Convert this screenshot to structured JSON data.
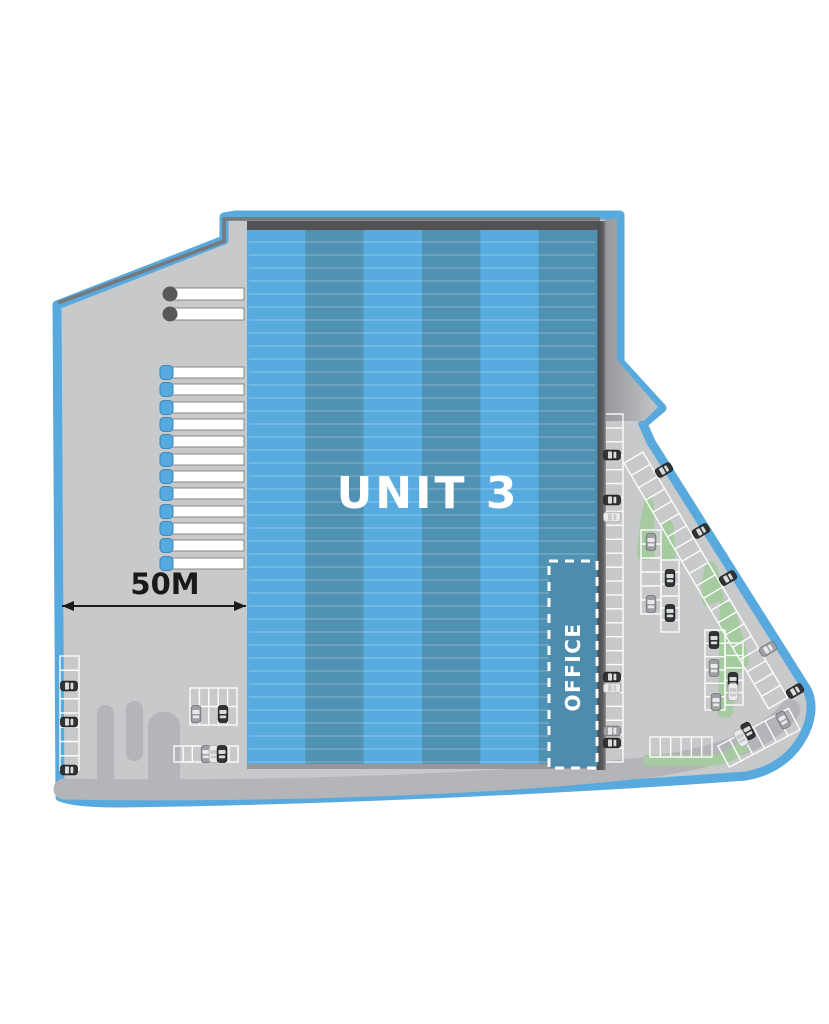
{
  "title": "Warehouse site plan - Unit 3",
  "labels": {
    "unit": "UNIT 3",
    "office": "OFFICE",
    "dimension": "50M"
  },
  "colors": {
    "boundary": "#57A9DE",
    "pavement": "#C7C9CB",
    "road": "#B3B5B8",
    "road_dark": "#B7B9BB",
    "edge_dark": "#76787A",
    "roof_edge": "#515254",
    "stripe_light": "#57ABDF",
    "stripe_dark": "#5092B3",
    "office_fill": "#4E8CAE",
    "green": "#A6CBA0",
    "stall_line": "#FFFFFF",
    "dock_bar": "#FFFFFF",
    "dock_bar_stroke": "#85878A",
    "dock_cap_blue": "#56AADE",
    "dock_cap_gray": "#58595B",
    "car_dark_body": "#313335",
    "car_silver_body": "#9EA0A3",
    "car_white_body": "#E9EAEB",
    "text_dark": "#1A1A1A",
    "text_light": "#FFFFFF"
  },
  "building": {
    "x": 247,
    "y": 230,
    "w": 350,
    "h": 536,
    "stripe_count": 6,
    "roof_line_step": 13
  },
  "loading_docks": {
    "gray_docks": [
      {
        "y": 288
      },
      {
        "y": 308
      }
    ],
    "blue_docks": [
      {
        "y": 367
      },
      {
        "y": 384
      },
      {
        "y": 402
      },
      {
        "y": 419
      },
      {
        "y": 436
      },
      {
        "y": 454
      },
      {
        "y": 471
      },
      {
        "y": 488
      },
      {
        "y": 506
      },
      {
        "y": 523
      },
      {
        "y": 540
      },
      {
        "y": 558
      }
    ],
    "bar": {
      "x": 172,
      "w": 72,
      "h": 12
    }
  },
  "parking_groups": [
    {
      "name": "west-column",
      "x": 60,
      "y": 656,
      "w": 19,
      "h": 114,
      "cols": 1,
      "rows": 8
    },
    {
      "name": "southwest-block",
      "x": 190,
      "y": 688,
      "w": 47,
      "h": 37,
      "cols": 5,
      "rows": 2
    },
    {
      "name": "southwest-row",
      "x": 174,
      "y": 746,
      "w": 64,
      "h": 16,
      "cols": 7,
      "rows": 1
    },
    {
      "name": "east-strip",
      "x": 601,
      "y": 414,
      "w": 22,
      "h": 348,
      "cols": 1,
      "rows": 25
    },
    {
      "name": "mid-strip-left",
      "x": 641,
      "y": 530,
      "w": 20,
      "h": 84,
      "cols": 1,
      "rows": 6
    },
    {
      "name": "mid-strip-right",
      "x": 661,
      "y": 560,
      "w": 18,
      "h": 72,
      "cols": 1,
      "rows": 6
    },
    {
      "name": "lower-block-left",
      "x": 705,
      "y": 630,
      "w": 20,
      "h": 80,
      "cols": 1,
      "rows": 6
    },
    {
      "name": "lower-block-right",
      "x": 725,
      "y": 643,
      "w": 18,
      "h": 62,
      "cols": 1,
      "rows": 5
    },
    {
      "name": "south-row",
      "x": 650,
      "y": 737,
      "w": 62,
      "h": 20,
      "cols": 6,
      "rows": 1
    },
    {
      "name": "boundary-diagonal",
      "x": 0,
      "y": 0,
      "w": 285,
      "h": 22,
      "cols": 20,
      "rows": 1,
      "t": "translate(643,452) rotate(59.5)"
    },
    {
      "name": "southeast-slant",
      "x": 0,
      "y": 0,
      "w": 80,
      "h": 24,
      "cols": 6,
      "rows": 1,
      "t": "translate(718,746) rotate(-28)"
    }
  ],
  "cars": [
    {
      "x": 69,
      "y": 686,
      "a": 0,
      "c": "dark"
    },
    {
      "x": 69,
      "y": 722,
      "a": 0,
      "c": "dark"
    },
    {
      "x": 69,
      "y": 770,
      "a": 0,
      "c": "dark"
    },
    {
      "x": 196,
      "y": 714,
      "a": 90,
      "c": "silver"
    },
    {
      "x": 223,
      "y": 714,
      "a": 90,
      "c": "dark"
    },
    {
      "x": 206,
      "y": 754,
      "a": 90,
      "c": "silver"
    },
    {
      "x": 214,
      "y": 754,
      "a": 90,
      "c": "white"
    },
    {
      "x": 222,
      "y": 754,
      "a": 90,
      "c": "dark"
    },
    {
      "x": 612,
      "y": 455,
      "a": 0,
      "c": "dark"
    },
    {
      "x": 612,
      "y": 500,
      "a": 0,
      "c": "dark"
    },
    {
      "x": 612,
      "y": 517,
      "a": 0,
      "c": "white"
    },
    {
      "x": 612,
      "y": 677,
      "a": 0,
      "c": "dark"
    },
    {
      "x": 612,
      "y": 688,
      "a": 0,
      "c": "white"
    },
    {
      "x": 612,
      "y": 731,
      "a": 0,
      "c": "silver"
    },
    {
      "x": 612,
      "y": 743,
      "a": 0,
      "c": "dark"
    },
    {
      "x": 651,
      "y": 542,
      "a": 90,
      "c": "silver"
    },
    {
      "x": 670,
      "y": 578,
      "a": 90,
      "c": "dark"
    },
    {
      "x": 651,
      "y": 604,
      "a": 90,
      "c": "silver"
    },
    {
      "x": 670,
      "y": 613,
      "a": 90,
      "c": "dark"
    },
    {
      "x": 714,
      "y": 640,
      "a": 90,
      "c": "dark"
    },
    {
      "x": 714,
      "y": 668,
      "a": 90,
      "c": "silver"
    },
    {
      "x": 733,
      "y": 681,
      "a": 90,
      "c": "dark"
    },
    {
      "x": 733,
      "y": 692,
      "a": 90,
      "c": "white"
    },
    {
      "x": 716,
      "y": 702,
      "a": 90,
      "c": "silver"
    },
    {
      "x": 664,
      "y": 470,
      "a": -30,
      "c": "dark"
    },
    {
      "x": 701,
      "y": 531,
      "a": -30,
      "c": "dark"
    },
    {
      "x": 728,
      "y": 578,
      "a": -30,
      "c": "dark"
    },
    {
      "x": 768,
      "y": 649,
      "a": -30,
      "c": "silver"
    },
    {
      "x": 795,
      "y": 691,
      "a": -30,
      "c": "dark"
    },
    {
      "x": 748,
      "y": 731,
      "a": 62,
      "c": "dark"
    },
    {
      "x": 741,
      "y": 738,
      "a": 62,
      "c": "white"
    },
    {
      "x": 783,
      "y": 720,
      "a": 62,
      "c": "silver"
    }
  ],
  "green_areas": [
    "M646,497 C652,495 654,502 654,510 L655,554 Q655,560 648,560 L641,560 Q636,560 637,552 C639,532 641,512 646,497 Z",
    "M666,520 C672,518 674,525 674,533 L676,554 Q676,560 669,560 L663,560 Q659,558 660,550 L662,528 Z",
    "M706,562 C712,558 717,564 719,574 L724,600 L704,606 Q700,596 702,580 Z",
    "M720,601 C730,598 736,610 740,626 L748,655 Q751,664 744,669 L738,674 Q734,676 734,684 L733,712 Q732,718 725,718 L718,716 Z",
    "M644,755 L712,755 Q728,752 740,741 L750,748 Q734,764 712,766 L644,766 Z"
  ],
  "dimension": {
    "x1": 62,
    "x2": 246,
    "y": 606,
    "label_x": 165,
    "label_y": 594
  }
}
